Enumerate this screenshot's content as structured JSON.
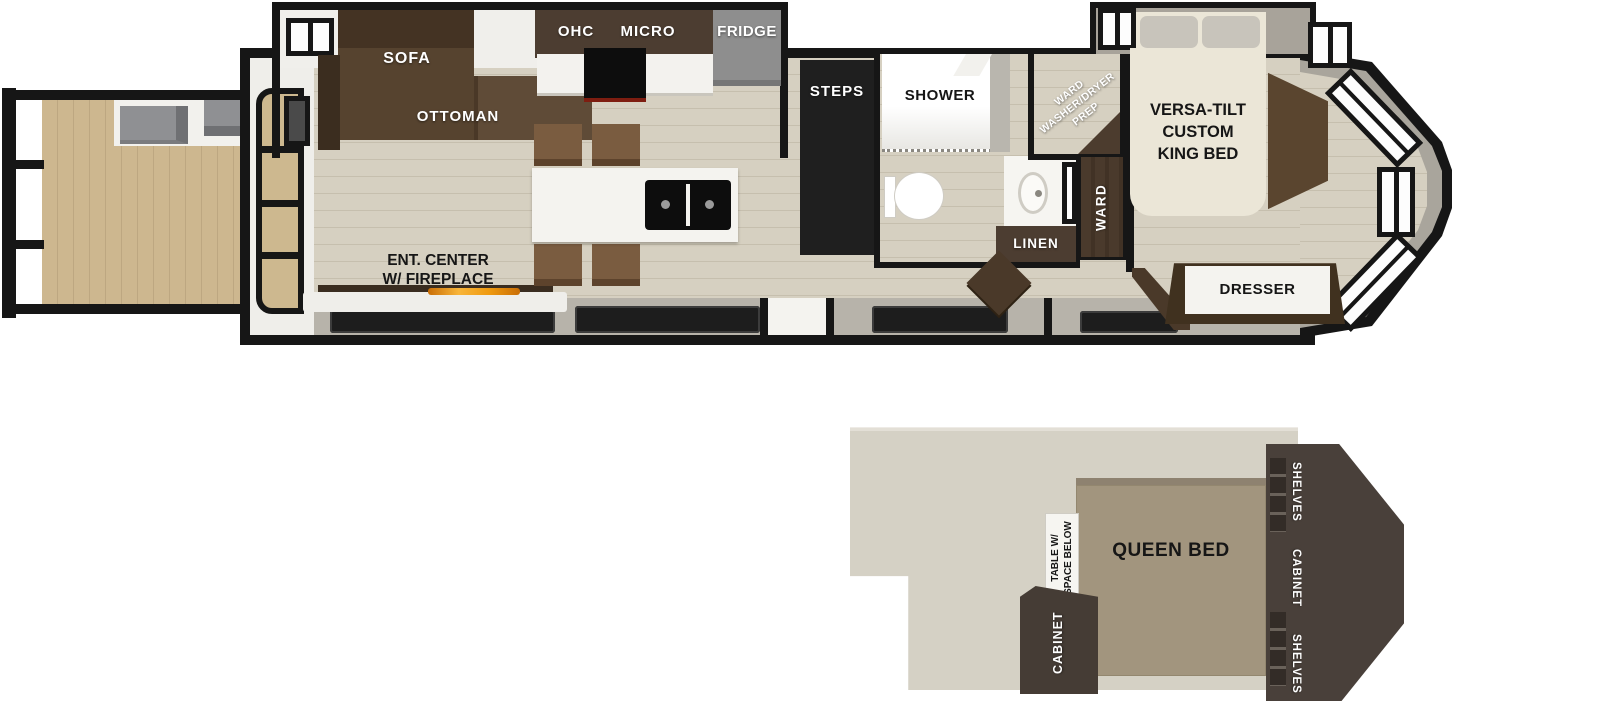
{
  "title": "Destination trailer floor plan with rear deck and loft",
  "colors": {
    "wall": "#161616",
    "deck_wood": "#cdb78f",
    "main_floor": "#d6d0c1",
    "skirt_gray": "#b7b3aa",
    "slide_wall_gray": "#a8a39a",
    "dark_cabinet_brown": "#4c3d30",
    "sofa_brown": "#4a3827",
    "ottoman_brown": "#5f4b37",
    "chair_brown": "#7a5c40",
    "appliance_gray": "#8e8e8e",
    "counter_white": "#f3f2ee",
    "king_bed_cream": "#ebe6d7",
    "pillow_gray": "#c8c4bb",
    "queen_bed_taupe": "#a2957e",
    "loft_floor": "#d5d1c5",
    "loft_cabinet": "#453c35",
    "flame_orange": "#ef9a10",
    "window_dark": "#1d1d1d"
  },
  "main": {
    "sofa_label": "SOFA",
    "ottoman_label": "OTTOMAN",
    "ohc_label": "OHC",
    "micro_label": "MICRO",
    "fridge_label": "FRIDGE",
    "ent_center_label": "ENT. CENTER\nW/ FIREPLACE",
    "steps_label": "STEPS",
    "shower_label": "SHOWER",
    "wd_prep_label": "WARD\nWASHER/DRYER\nPREP",
    "linen_label": "LINEN",
    "ward_label": "WARD",
    "king_bed_label": "VERSA-TILT\nCUSTOM\nKING BED",
    "dresser_label": "DRESSER"
  },
  "loft": {
    "queen_bed_label": "QUEEN BED",
    "table_label": "TABLE W/\nSPACE BELOW",
    "cabinet_label": "CABINET",
    "shelves_top_label": "SHELVES",
    "cabinet_side_label": "CABINET",
    "shelves_bottom_label": "SHELVES"
  }
}
